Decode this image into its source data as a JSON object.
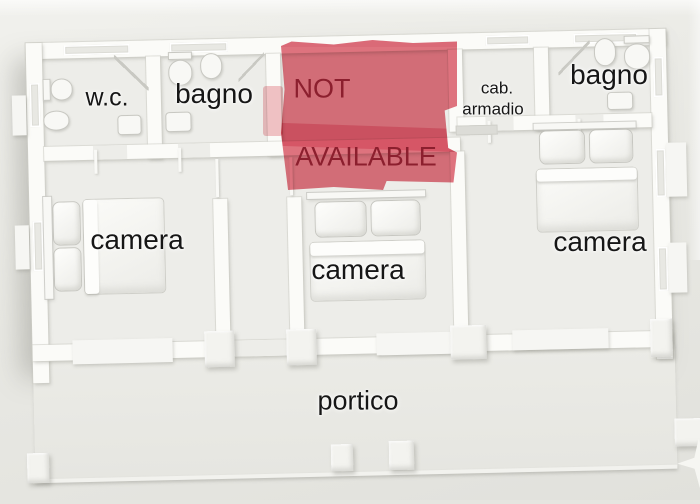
{
  "image_type": "3d-rendered floor plan with availability overlay",
  "colors": {
    "page-bg-top": "#f1f1ed",
    "page-bg-bottom": "#e1e1dc",
    "floor": "#edede9",
    "wall": "#fbfbf8",
    "overlay-fill": "#e06a78",
    "overlay-band": "#d7495c",
    "overlay-text": "#8c1f2e",
    "label": "#161616"
  },
  "labels": {
    "wc": "w.c.",
    "bagno_left": "bagno",
    "bagno_right": "bagno",
    "cab_line1": "cab.",
    "cab_line2": "armadio",
    "camera_left": "camera",
    "camera_middle": "camera",
    "camera_right": "camera",
    "portico": "portico",
    "overlay_line1": "NOT",
    "overlay_line2": "AVAILABLE"
  }
}
